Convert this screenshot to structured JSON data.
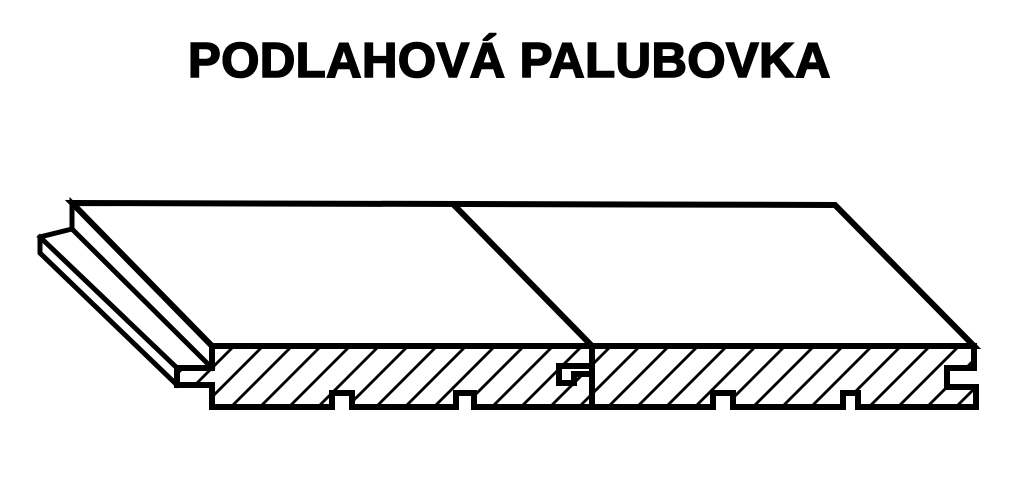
{
  "title": "PODLAHOVÁ PALUBOVKA",
  "colors": {
    "background": "#ffffff",
    "line": "#000000"
  },
  "drawing": {
    "type": "technical-diagram",
    "subject": "tongue-and-groove floorboard, isometric view with hatched cross-section",
    "hatch": {
      "style": "diagonal",
      "direction": "/",
      "spacing_px": 29
    },
    "paths": {
      "top_face": "M 72 203 L 835 205 L 974 346 L 212 346 Z",
      "board1_section": "M 212 346 L 592 346 L 592 366 L 559 366 L 559 383 L 574 383 L 574 374 L 592 374 L 592 407 L 474 407 L 474 393 L 456 393 L 456 407 L 352 407 L 352 393 L 332 393 L 332 407 L 212 407 L 212 385 L 177 385 L 177 368 L 212 368 Z",
      "board2_section": "M 592 346 L 974 346 L 974 368 L 947 368 L 947 387 L 976 387 L 976 407 L 858 407 L 858 393 L 843 393 L 843 407 L 733 407 L 733 393 L 713 393 L 713 407 L 592 407 Z",
      "seam_line": "M 453 204 L 592 346",
      "edge_strip_upper": "M 212 346 L 72 203 L 72 229 L 212 368",
      "edge_strip_lower": "M 72 229 L 40 237 L 40 253 L 177 385",
      "tongue_top_edge": "M 40 237 L 177 368"
    }
  }
}
